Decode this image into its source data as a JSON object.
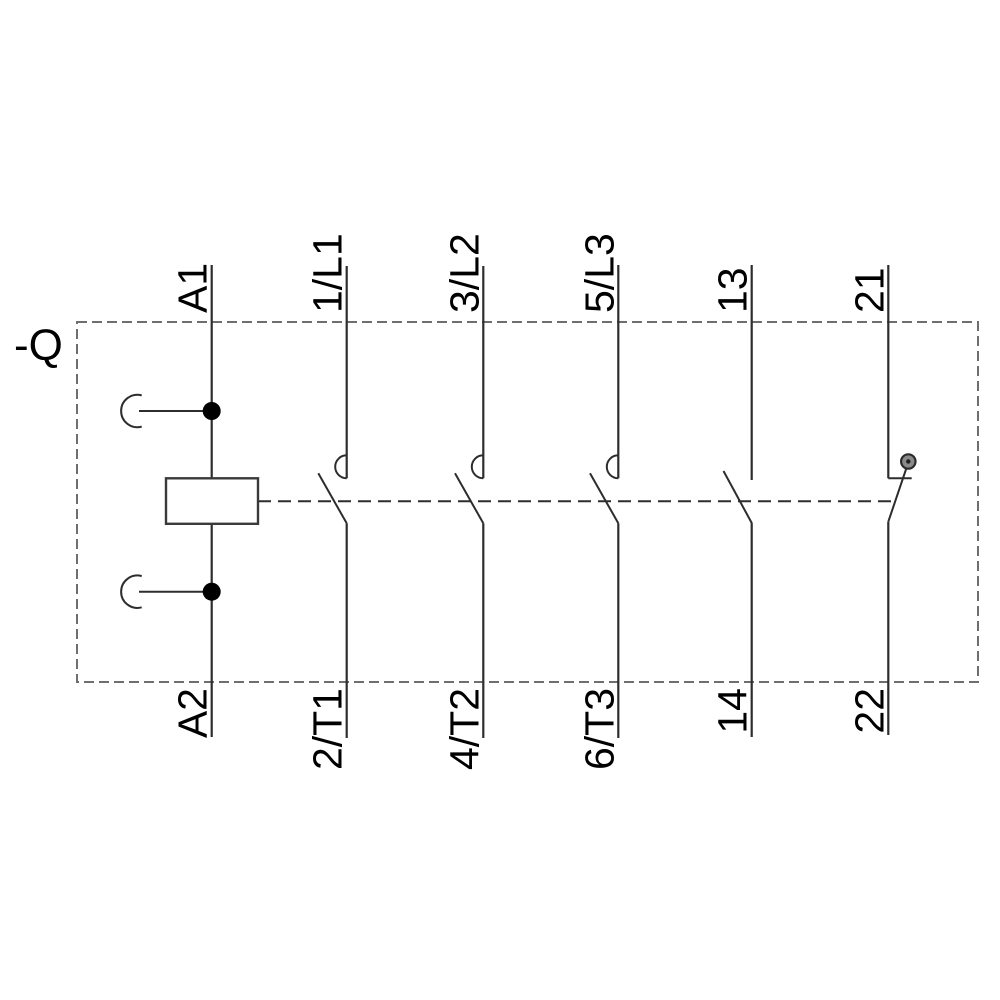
{
  "schematic": {
    "title": "contactor-wiring-diagram",
    "designation": "-Q",
    "coil": {
      "top_terminal": "A1",
      "bottom_terminal": "A2"
    },
    "poles": [
      {
        "top": "1/L1",
        "bottom": "2/T1"
      },
      {
        "top": "3/L2",
        "bottom": "4/T2"
      },
      {
        "top": "5/L3",
        "bottom": "6/T3"
      }
    ],
    "aux_no": {
      "top": "13",
      "bottom": "14"
    },
    "aux_nc": {
      "top": "21",
      "bottom": "22"
    },
    "colors": {
      "wire": "#2d2d2d",
      "boundary_dash": "#6e6e6e",
      "label_text": "#000000",
      "nc_pivot_fill": "#8a8a8a",
      "background": "#ffffff"
    }
  }
}
